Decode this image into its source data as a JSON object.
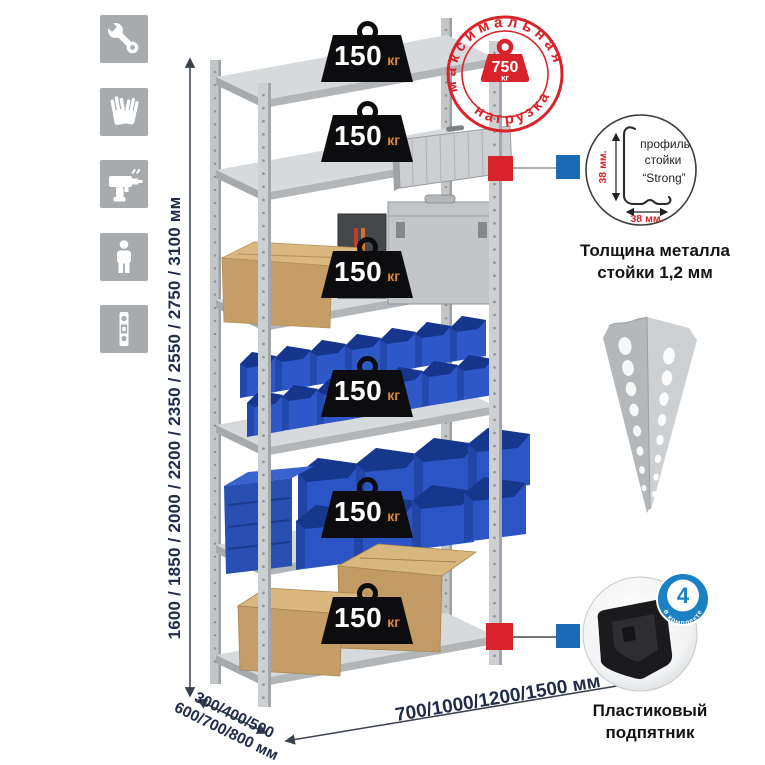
{
  "illustration": {
    "left_icons": [
      {
        "name": "wrench-icon"
      },
      {
        "name": "gloves-icon"
      },
      {
        "name": "drill-icon"
      },
      {
        "name": "person-icon"
      },
      {
        "name": "level-icon"
      }
    ]
  },
  "dimensions": {
    "height": "1600 / 1850 / 2000 / 2200 / 2350 / 2550 / 2750 / 3100 мм",
    "depth_line1": "300/400/500",
    "depth_line2": "600/700/800 мм",
    "width": "700/1000/1200/1500 мм"
  },
  "shelf_load": {
    "weights": [
      {
        "value": "150",
        "unit": "кг"
      },
      {
        "value": "150",
        "unit": "кг"
      },
      {
        "value": "150",
        "unit": "кг"
      },
      {
        "value": "150",
        "unit": "кг"
      },
      {
        "value": "150",
        "unit": "кг"
      },
      {
        "value": "150",
        "unit": "кг"
      }
    ]
  },
  "max_load_stamp": {
    "top_text": "максимальная",
    "bottom_text": "нагрузка",
    "value": "750",
    "unit": "кг"
  },
  "profile_detail": {
    "line1": "профиль",
    "line2": "стойки",
    "line3": "“Strong”",
    "height_dim": "38 мм.",
    "width_dim": "38 мм.",
    "caption_line1": "Толщина металла",
    "caption_line2": "стойки 1,2 мм"
  },
  "foot_detail": {
    "badge_number": "4",
    "badge_text": "в комплекте",
    "caption_line1": "Пластиковый",
    "caption_line2": "подпятник"
  },
  "colors": {
    "accent_red": "#d8232a",
    "accent_blue": "#1a6ab5",
    "bin_blue": "#2e58c8",
    "metal_gray": "#c6c9cc",
    "weight_black": "#0d0d0f",
    "kg_orange": "#e0873f",
    "dimension_text": "#202c49",
    "badge_blue": "#1b80c4"
  }
}
